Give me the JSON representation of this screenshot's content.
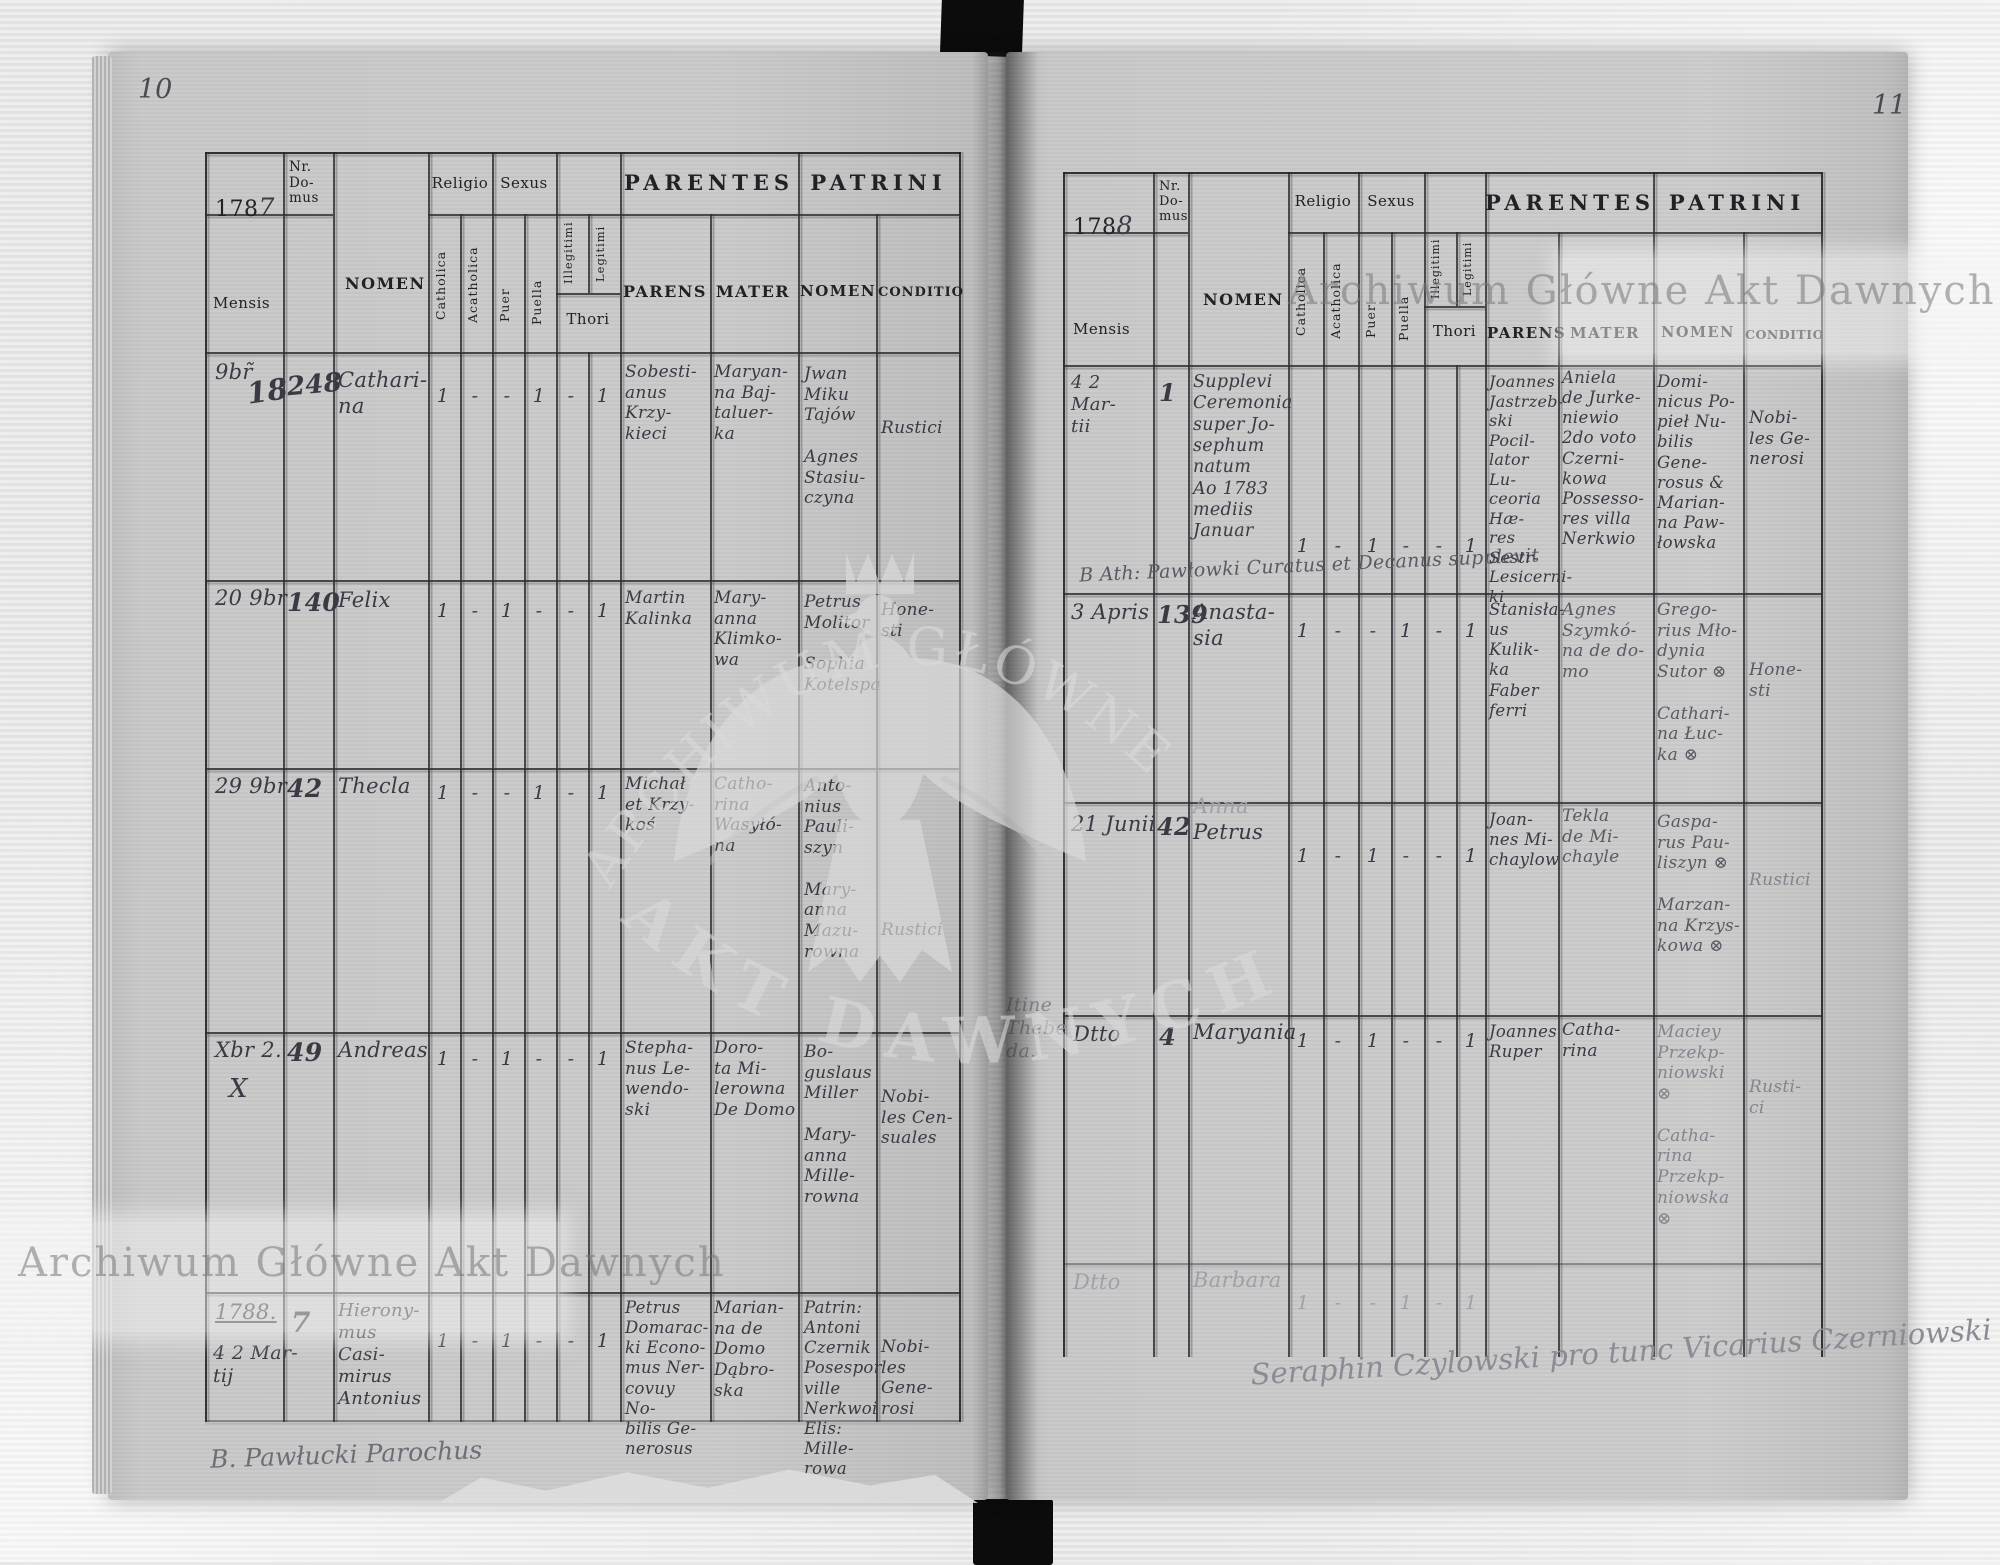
{
  "meta": {
    "watermark": "Archiwum Główne Akt Dawnych",
    "seal_top": "ARCHIWUM GŁÓWNE",
    "seal_bottom": "AKT DAWNYCH"
  },
  "left": {
    "page_number": "10",
    "year_printed": "178",
    "year_written": "7",
    "header": {
      "nr_domus": "Nr.\nDo-\nmus",
      "mensis": "Mensis",
      "nomen": "NOMEN",
      "religio": "Religio",
      "catholica": "Catholica",
      "acatholica": "Acatholica",
      "sexus": "Sexus",
      "puer": "Puer",
      "puella": "Puella",
      "illegitimi": "Illegitimi",
      "legitimi": "Legitimi",
      "thori": "Thori",
      "parentes": "PARENTES",
      "parens": "PARENS",
      "mater": "MATER",
      "patrini": "PATRINI",
      "patrini_nomen": "NOMEN",
      "conditio": "CONDITIO"
    },
    "rows": [
      {
        "mensis": "9br̃",
        "mensis2": "18",
        "nr": "248",
        "nomen": "Cathari-\nna",
        "catholica": "1",
        "acatholica": "-",
        "puer": "-",
        "puella": "1",
        "illegitimi": "-",
        "legitimi": "1",
        "parens": "Sobesti-\nanus Krzy-\nkieci",
        "mater": "Maryan-\nna Baj-\ntaluer-\nka",
        "patrini_nomen": "Jwan\nMiku\nTajów\n\nAgnes\nStasiu-\nczyna",
        "conditio": "Rustici"
      },
      {
        "mensis": "20 9br",
        "mensis2": "",
        "nr": "140",
        "nomen": "Felix",
        "catholica": "1",
        "acatholica": "-",
        "puer": "1",
        "puella": "-",
        "illegitimi": "-",
        "legitimi": "1",
        "parens": "Martin\nKalinka",
        "mater": "Mary-\nanna\nKlimko-\nwa",
        "patrini_nomen": "Petrus\nMolitor\n\nSophia\nKotelspa",
        "conditio": "Hone-\nsti"
      },
      {
        "mensis": "29 9br",
        "mensis2": "",
        "nr": "42",
        "nomen": "Thecla",
        "catholica": "1",
        "acatholica": "-",
        "puer": "-",
        "puella": "1",
        "illegitimi": "-",
        "legitimi": "1",
        "parens": "Michał\net Krzy-\nkoś",
        "mater": "Catho-\nrina\nWasyłó-\nna",
        "patrini_nomen": "Anto-\nnius\nPauli-\nszyn\n\nMary-\nanna\nMazu-\nrowna",
        "conditio": "Rustici"
      },
      {
        "mensis": "Xbr 2.",
        "mensis2": "X",
        "nr": "49",
        "nomen": "Andreas",
        "catholica": "1",
        "acatholica": "-",
        "puer": "1",
        "puella": "-",
        "illegitimi": "-",
        "legitimi": "1",
        "parens": "Stepha-\nnus Le-\nwendo-\nski",
        "mater": "Doro-\nta Mi-\nlerowna\nDe Domo",
        "patrini_nomen": "Bo-\nguslaus\nMiller\n\nMary-\nanna\nMille-\nrowna",
        "conditio": "Nobi-\nles Cen-\nsuales"
      },
      {
        "mensis": "1788.",
        "mensis2": "4 2 Mar-\ntij",
        "nr": "7",
        "nomen": "Hierony-\nmus Casi-\nmirus\nAntonius",
        "catholica": "1",
        "acatholica": "-",
        "puer": "1",
        "puella": "-",
        "illegitimi": "-",
        "legitimi": "1",
        "parens": "Petrus\nDomarac-\nki Econo-\nmus Ner-\ncovuy No-\nbilis Ge-\nnerosus",
        "mater": "Marian-\nna de\nDomo\nDąbro-\nska",
        "patrini_nomen": "Patrin:\nAntoni\nCzernik\nPosespor\nville\nNerkwoi\nElis: Mille-\nrowa",
        "conditio": "Nobi-\nles Gene-\nrosi"
      }
    ],
    "signature": "B. Pawłucki Parochus"
  },
  "right": {
    "page_number": "11",
    "year_printed": "178",
    "year_written": "8",
    "header": {
      "nr_domus": "Nr.\nDo-\nmus",
      "mensis": "Mensis",
      "nomen": "NOMEN",
      "religio": "Religio",
      "catholica": "Catholica",
      "acatholica": "Acatholica",
      "sexus": "Sexus",
      "puer": "Puer",
      "puella": "Puella",
      "illegitimi": "Illegitimi",
      "legitimi": "Legitimi",
      "thori": "Thori",
      "parentes": "PARENTES",
      "parens": "PARENS",
      "mater": "MATER",
      "patrini": "PATRINI",
      "patrini_nomen": "NOMEN",
      "conditio": "CONDITIO"
    },
    "margin_note": "Itine\nThebe\nda.",
    "rows": [
      {
        "mensis": "4 2 Mar-\ntii",
        "nr": "1",
        "nomen": "Supplevi\nCeremonia\nsuper Jo-\nsephum\nnatum\nAo 1783\nmediis\nJanuar",
        "note": "B Ath: Pawłowki   Curatus et Decanus supplevit",
        "catholica": "1",
        "acatholica": "-",
        "puer": "1",
        "puella": "-",
        "illegitimi": "-",
        "legitimi": "1",
        "parens": "Joannes\nJastrzeb-\nski Pocil-\nlator Lu-\nceoria Hæ-\nres Sestr-\nLesicerni-\nki",
        "mater": "Aniela\nde Jurke-\nniewio\n2do voto\nCzerni-\nkowa\nPossesso-\nres villa\nNerkwio",
        "patrini_nomen": "Domi-\nnicus Po-\npieł Nu-\nbilis Gene-\nrosus &\nMarian-\nna Paw-\nłowska",
        "conditio": "Nobi-\nles Ge-\nnerosi"
      },
      {
        "mensis": "3 Apris",
        "nr": "139",
        "nomen": "Anasta-\nsia",
        "catholica": "1",
        "acatholica": "-",
        "puer": "-",
        "puella": "1",
        "illegitimi": "-",
        "legitimi": "1",
        "parens": "Stanisła-\nus Kulik-\nka Faber\nferri",
        "mater": "Agnes\nSzymkó-\nna de do-\nmo",
        "patrini_nomen": "Grego-\nrius Mło-\ndynia\nSutor ⊗\n\nCathari-\nna Łuc-\nka ⊗",
        "conditio": "Hone-\nsti"
      },
      {
        "mensis": "21 Junii",
        "nr": "42",
        "nomen_ghost": "Anna",
        "nomen": "Petrus",
        "catholica": "1",
        "acatholica": "-",
        "puer": "1",
        "puella": "-",
        "illegitimi": "-",
        "legitimi": "1",
        "parens": "Joan-\nnes Mi-\nchaylow",
        "mater": "Tekla\nde Mi-\nchayle",
        "patrini_nomen": "Gaspa-\nrus Pau-\nliszyn ⊗\n\nMarzan-\nna Krzys-\nkowa ⊗",
        "conditio": "Rustici"
      },
      {
        "mensis": "Dtto",
        "nr": "4",
        "nomen": "Maryania",
        "catholica": "1",
        "acatholica": "-",
        "puer": "1",
        "puella": "-",
        "illegitimi": "-",
        "legitimi": "1",
        "parens": "Joannes\nRuper",
        "mater": "Catha-\nrina",
        "patrini_nomen": "Maciey\nPrzekp-\nniowski ⊗\n\nCatha-\nrina\nPrzekp-\nniowska ⊗",
        "conditio": "Rusti-\nci"
      },
      {
        "mensis": "Dtto",
        "nr": "",
        "nomen": "Barbara",
        "catholica": "1",
        "acatholica": "-",
        "puer": "-",
        "puella": "1",
        "illegitimi": "-",
        "legitimi": "1",
        "parens": "",
        "mater": "",
        "patrini_nomen": "",
        "conditio": ""
      }
    ],
    "signature": "Seraphin Czylowski pro tunc Vicarius Czerniowski"
  }
}
